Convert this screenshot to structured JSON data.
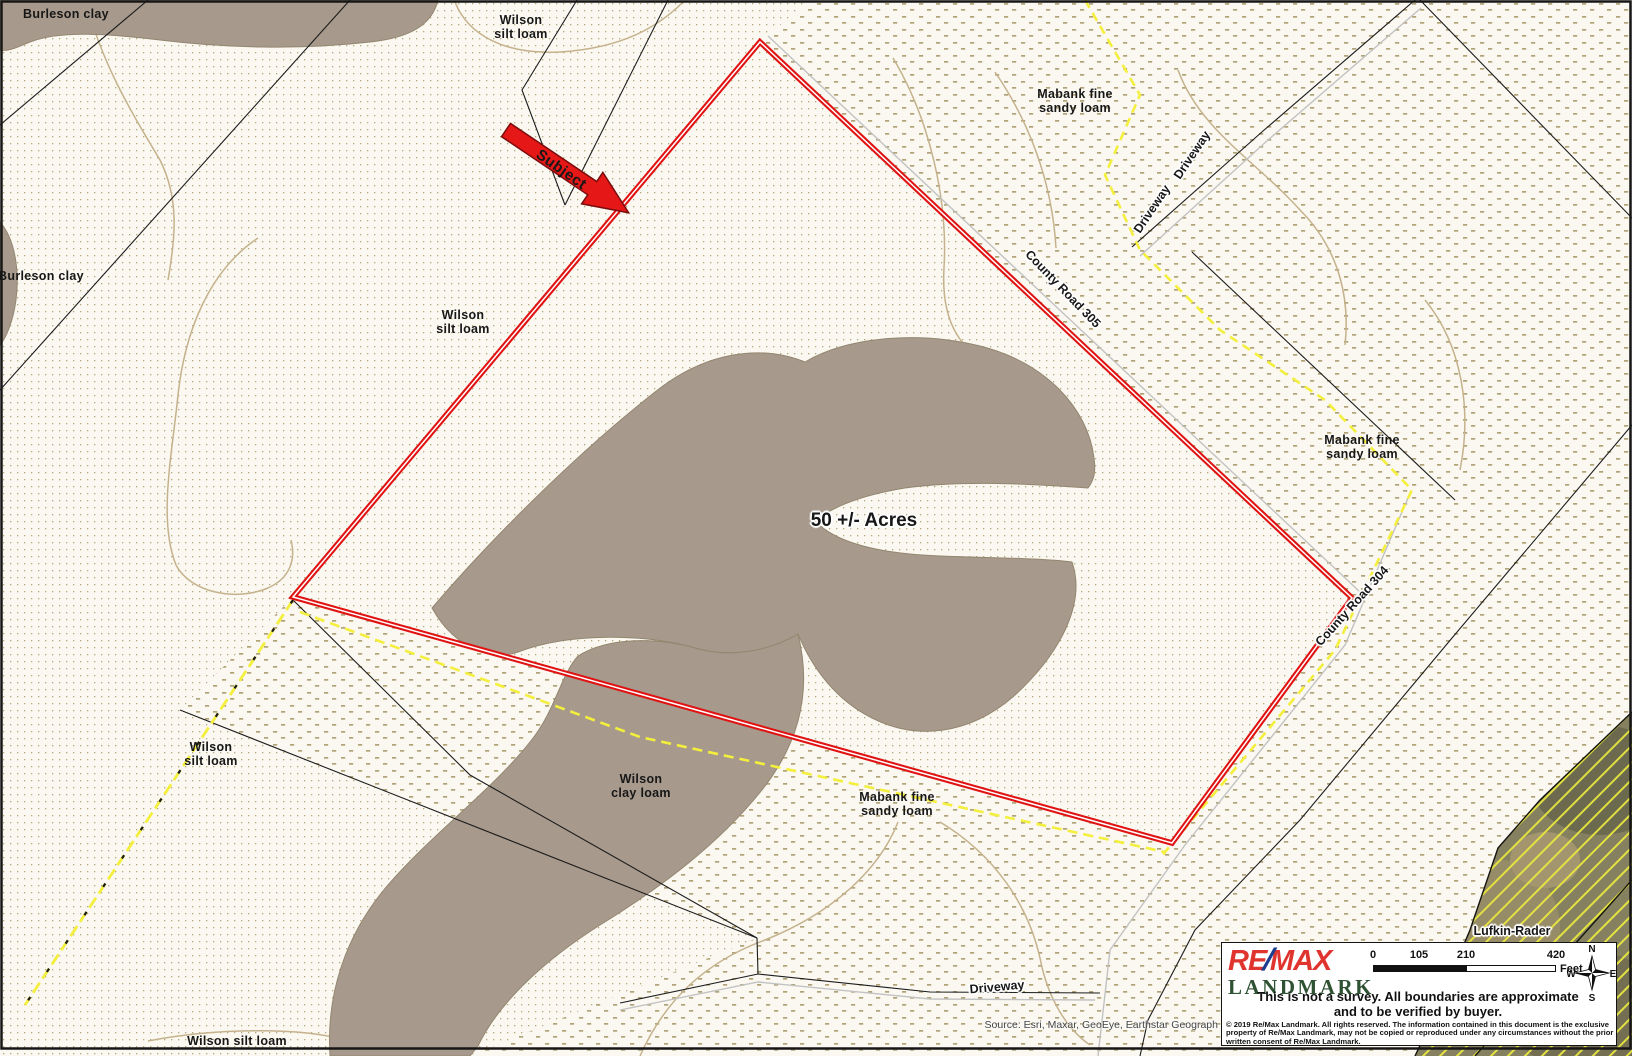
{
  "map_labels": [
    {
      "name": "label-burleson-clay-top",
      "lines": [
        "Burleson clay"
      ],
      "x": 66,
      "y": 14,
      "rot": 0,
      "cls": "soil"
    },
    {
      "name": "label-wilson-silt-loam-top",
      "lines": [
        "Wilson",
        "silt loam"
      ],
      "x": 521,
      "y": 27,
      "rot": 0,
      "cls": "soil"
    },
    {
      "name": "label-mabank-fine-sandy-loam-top",
      "lines": [
        "Mabank fine",
        "sandy loam"
      ],
      "x": 1075,
      "y": 101,
      "rot": 0,
      "cls": "soil"
    },
    {
      "name": "label-burleson-clay-left",
      "lines": [
        "Burleson clay"
      ],
      "x": 41,
      "y": 276,
      "rot": 0,
      "cls": "soil"
    },
    {
      "name": "label-wilson-silt-loam-mid",
      "lines": [
        "Wilson",
        "silt loam"
      ],
      "x": 463,
      "y": 322,
      "rot": 0,
      "cls": "soil"
    },
    {
      "name": "label-mabank-fine-sandy-loam-right",
      "lines": [
        "Mabank fine",
        "sandy loam"
      ],
      "x": 1362,
      "y": 447,
      "rot": 0,
      "cls": "soil"
    },
    {
      "name": "label-wilson-silt-loam-sw",
      "lines": [
        "Wilson",
        "silt loam"
      ],
      "x": 211,
      "y": 754,
      "rot": 0,
      "cls": "soil"
    },
    {
      "name": "label-wilson-clay-loam",
      "lines": [
        "Wilson",
        "clay loam"
      ],
      "x": 641,
      "y": 786,
      "rot": 0,
      "cls": "soil"
    },
    {
      "name": "label-mabank-fine-sandy-loam-south",
      "lines": [
        "Mabank fine",
        "sandy loam"
      ],
      "x": 897,
      "y": 804,
      "rot": 0,
      "cls": "soil"
    },
    {
      "name": "label-wilson-silt-loam-bottom",
      "lines": [
        "Wilson silt loam"
      ],
      "x": 237,
      "y": 1041,
      "rot": 0,
      "cls": "soil"
    },
    {
      "name": "label-lufkin-rader",
      "lines": [
        "Lufkin-Rader"
      ],
      "x": 1512,
      "y": 931,
      "rot": 0,
      "cls": "road"
    },
    {
      "name": "label-acreage",
      "lines": [
        "50 +/- Acres"
      ],
      "x": 864,
      "y": 521,
      "rot": 0,
      "cls": "acres"
    },
    {
      "name": "label-subject",
      "lines": [
        "Subject"
      ],
      "x": 561,
      "y": 170,
      "rot": 35,
      "cls": "subject"
    },
    {
      "name": "label-county-road-305",
      "lines": [
        "County Road 305"
      ],
      "x": 1063,
      "y": 289,
      "rot": 46,
      "cls": "road"
    },
    {
      "name": "label-county-road-304",
      "lines": [
        "County Road 304"
      ],
      "x": 1352,
      "y": 606,
      "rot": -48,
      "cls": "road"
    },
    {
      "name": "label-driveway-ne-1",
      "lines": [
        "Driveway"
      ],
      "x": 1152,
      "y": 209,
      "rot": -56,
      "cls": "road"
    },
    {
      "name": "label-driveway-ne-2",
      "lines": [
        "Driveway"
      ],
      "x": 1192,
      "y": 155,
      "rot": -56,
      "cls": "road"
    },
    {
      "name": "label-driveway-south",
      "lines": [
        "Driveway"
      ],
      "x": 997,
      "y": 987,
      "rot": -5,
      "cls": "road"
    }
  ],
  "legend": {
    "remax_re": "RE",
    "remax_slash": "/",
    "remax_max": "MAX",
    "landmark": "LANDMARK",
    "scale_ticks": [
      "0",
      "105",
      "210",
      "420"
    ],
    "feet_label": "Feet",
    "compass": {
      "n": "N",
      "e": "E",
      "s": "S",
      "w": "W"
    },
    "survey_note_1": "This is not a survey.  All boundaries are approximate",
    "survey_note_2": "and to be verified by buyer.",
    "copyright_1": "© 2019 Re/Max Landmark. All rights reserved. The information contained in this document is the exclusive",
    "copyright_2": "property of Re/Max Landmark, may not be copied or reproduced under any circumstances without the prior",
    "copyright_3": "written consent of Re/Max Landmark."
  },
  "source_credit": "Source: Esri, Maxar, GeoEye, Earthstar Geograph",
  "colors": {
    "parcel_red": "#e01212",
    "trail_yellow": "#f4ef3c",
    "soil_patch_brown": "#a79a8c",
    "contour_tan": "#c5b28c",
    "stipple_tan": "#b5a87f",
    "remax_red": "#e0342f",
    "remax_blue": "#1e3d8f",
    "landmark_green": "#2f5233"
  }
}
